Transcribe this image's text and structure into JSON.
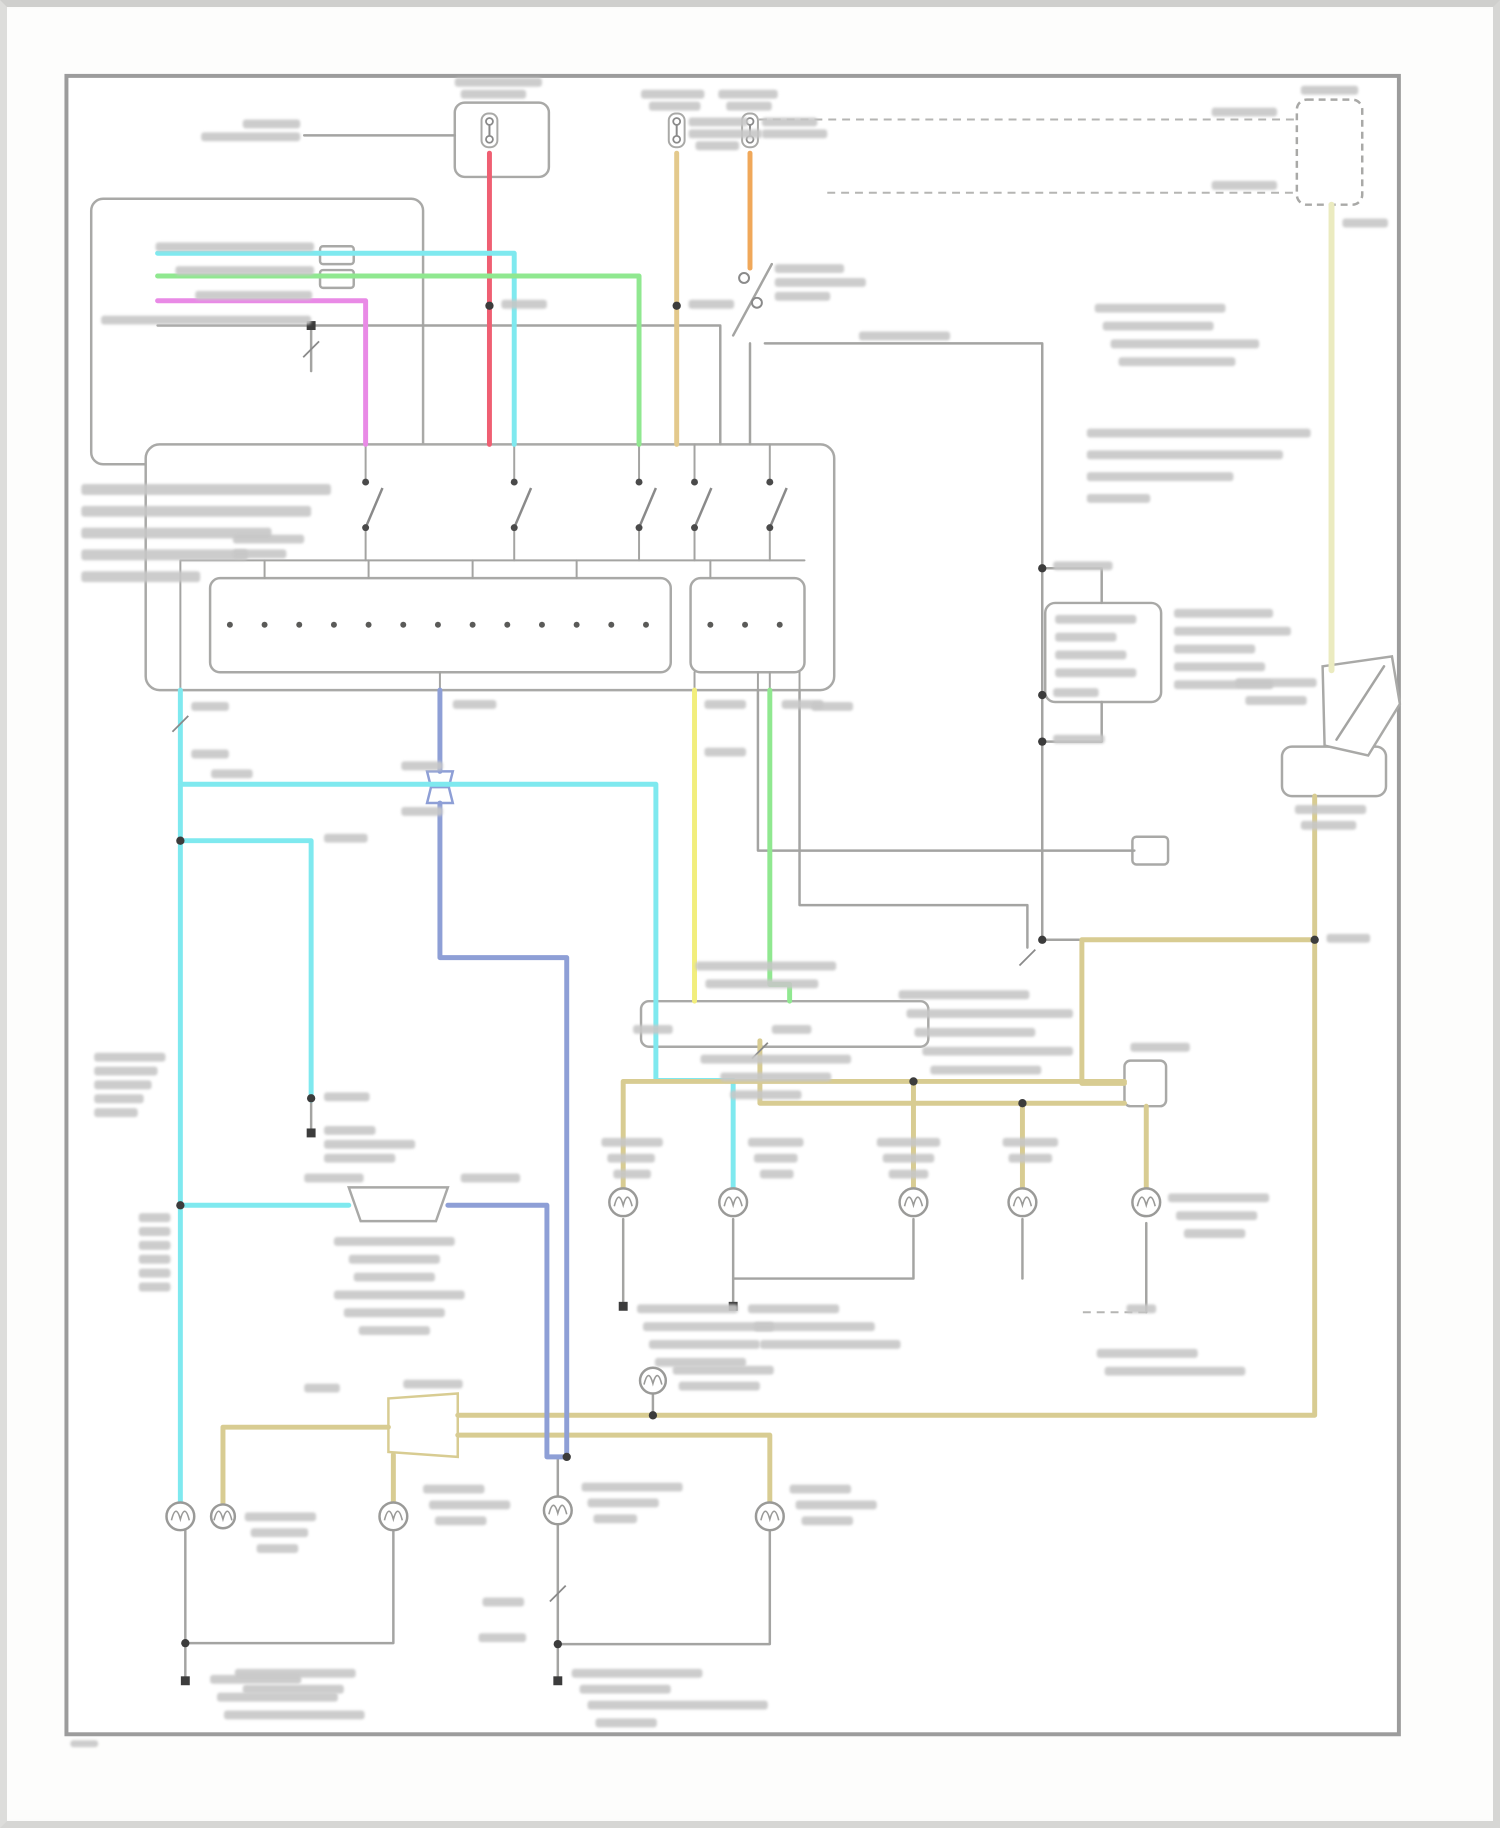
{
  "canvas": {
    "w": 1500,
    "h": 1828,
    "sheet": "#fdfdfc"
  },
  "frame": {
    "x": 60,
    "y": 68,
    "w": 1345,
    "h": 1674,
    "stroke": "#9c9c9c",
    "width": 4
  },
  "palette": {
    "gray": "#a4a4a2",
    "darkgray": "#8a8a8a",
    "boxstroke": "#a9a9a7",
    "cyan": "#7fe9ef",
    "green": "#90e890",
    "magenta": "#e98ae6",
    "red": "#ef5f72",
    "tan": "#e3c98c",
    "orange": "#f0a85a",
    "khaki": "#d8cc92",
    "paleyellow": "#ebebc0",
    "yellow": "#f2ee7c",
    "blue": "#8e9fd6",
    "smudge": "#c7c7c7",
    "dot": "#3c3c3c"
  },
  "diagram": {
    "boxes": [
      [
        452,
        95,
        95,
        75,
        10,
        0
      ],
      [
        85,
        192,
        335,
        268,
        12,
        0
      ],
      [
        140,
        440,
        695,
        248,
        14,
        0
      ],
      [
        205,
        575,
        465,
        95,
        10,
        0
      ],
      [
        690,
        575,
        115,
        95,
        10,
        0
      ],
      [
        1302,
        92,
        66,
        106,
        10,
        1
      ],
      [
        1048,
        600,
        117,
        100,
        10,
        0
      ],
      [
        1287,
        745,
        105,
        50,
        10,
        0
      ],
      [
        640,
        1002,
        290,
        46,
        8,
        0
      ],
      [
        1128,
        1062,
        42,
        46,
        6,
        0
      ],
      [
        1136,
        836,
        36,
        28,
        4,
        0
      ],
      [
        316,
        240,
        34,
        18,
        3,
        0
      ],
      [
        316,
        264,
        34,
        18,
        3,
        0
      ]
    ],
    "polygons": [
      [
        "1328,664 1398,654 1406,702 1374,754 1330,744",
        "boxstroke"
      ],
      [
        "345,1190 445,1190 433,1224 357,1224",
        "boxstroke"
      ],
      [
        "385,1403 455,1398 455,1462 385,1457",
        "khaki"
      ],
      [
        "424,770 450,770 446,786 428,786",
        "blue"
      ],
      [
        "428,786 446,786 450,802 424,802",
        "blue"
      ]
    ],
    "wires": [
      [
        "gray",
        2.5,
        "300,128 452,128"
      ],
      [
        "gray",
        2.5,
        "733,330 772,258"
      ],
      [
        "gray",
        2.5,
        "750,338 750,440"
      ],
      [
        "gray",
        2.5,
        "765,338 1045,338 1045,940"
      ],
      [
        "gray",
        2.5,
        "152,320 720,320 720,440"
      ],
      [
        "gray",
        2.5,
        "307,320 307,366"
      ],
      [
        "gray",
        2.5,
        "758,688 758,850 1138,850"
      ],
      [
        "gray",
        2.5,
        "800,688 800,905 1030,905 1030,948"
      ],
      [
        "gray",
        2.5,
        "1342,738 1390,664"
      ],
      [
        "gray",
        2.5,
        "652,1398 652,1420"
      ],
      [
        "gray",
        2.5,
        "556,1462 556,1502"
      ],
      [
        "gray",
        2.5,
        "180,1536 180,1688"
      ],
      [
        "gray",
        2.5,
        "390,1536 390,1650 180,1650"
      ],
      [
        "gray",
        2.5,
        "556,1530 556,1688"
      ],
      [
        "gray",
        2.5,
        "770,1536 770,1651 556,1651"
      ],
      [
        "gray",
        2.5,
        "733,1222 733,1310"
      ],
      [
        "gray",
        2.5,
        "915,1222 915,1282 733,1282"
      ],
      [
        "gray",
        2.5,
        "622,1222 622,1310"
      ],
      [
        "gray",
        2.5,
        "1025,1222 1025,1282"
      ],
      [
        "gray",
        2.5,
        "1150,1226 1150,1316"
      ],
      [
        "gray",
        2.5,
        "307,1100 307,1135"
      ],
      [
        "gray",
        2.5,
        "1105,600 1105,565 1045,565"
      ],
      [
        "gray",
        2.5,
        "1105,700 1105,740 1045,740"
      ],
      [
        "gray",
        2.5,
        "1085,940 1045,940"
      ],
      [
        "gray",
        2,
        "362,440 362,478"
      ],
      [
        "gray",
        2,
        "512,440 512,478"
      ],
      [
        "gray",
        2,
        "638,440 638,478"
      ],
      [
        "gray",
        2,
        "694,440 694,478"
      ],
      [
        "gray",
        2,
        "770,440 770,478"
      ],
      [
        "gray",
        2,
        "362,524 362,557"
      ],
      [
        "gray",
        2,
        "512,524 512,557"
      ],
      [
        "gray",
        2,
        "638,524 638,557"
      ],
      [
        "gray",
        2,
        "694,524 694,557"
      ],
      [
        "gray",
        2,
        "770,524 770,557"
      ],
      [
        "gray",
        2,
        "175,557 805,557"
      ],
      [
        "gray",
        2,
        "260,557 260,575"
      ],
      [
        "gray",
        2,
        "365,557 365,575"
      ],
      [
        "gray",
        2,
        "470,557 470,575"
      ],
      [
        "gray",
        2,
        "575,557 575,575"
      ],
      [
        "gray",
        2,
        "710,557 710,575"
      ],
      [
        "gray",
        2,
        "175,557 175,688"
      ],
      [
        "gray",
        2,
        "437,670 437,688"
      ],
      [
        "gray",
        2,
        "694,670 694,688"
      ],
      [
        "gray",
        2,
        "770,670 770,688"
      ],
      [
        "gray",
        2,
        "758,670 758,688"
      ],
      [
        "gray",
        2,
        "800,670 800,688"
      ],
      [
        "red",
        5,
        "487,146 487,440"
      ],
      [
        "tan",
        5,
        "676,146 676,440"
      ],
      [
        "orange",
        5,
        "750,146 750,262"
      ],
      [
        "magenta",
        5,
        "152,295 362,295 362,440"
      ],
      [
        "cyan",
        5,
        "152,247 512,247 512,440"
      ],
      [
        "green",
        5,
        "152,270 638,270 638,440"
      ],
      [
        "cyan",
        5,
        "175,688 175,1508"
      ],
      [
        "cyan",
        5,
        "175,783 655,783 655,1082 733,1082 733,1191"
      ],
      [
        "cyan",
        5,
        "175,840 307,840 307,1102"
      ],
      [
        "cyan",
        5,
        "175,1208 345,1208"
      ],
      [
        "khaki",
        5,
        "218,1508 218,1432 385,1432"
      ],
      [
        "khaki",
        5,
        "390,1460 390,1508"
      ],
      [
        "khaki",
        5,
        "455,1420 1320,1420 1320,795"
      ],
      [
        "khaki",
        5,
        "455,1440 770,1440 770,1508"
      ],
      [
        "khaki",
        5,
        "1320,940 1085,940 1085,1085 1128,1085"
      ],
      [
        "khaki",
        5,
        "622,1191 622,1083 1128,1083"
      ],
      [
        "khaki",
        5,
        "915,1083 915,1191"
      ],
      [
        "khaki",
        5,
        "760,1042 760,1105 1128,1105"
      ],
      [
        "khaki",
        5,
        "1025,1105 1025,1191"
      ],
      [
        "khaki",
        5,
        "1150,1108 1150,1191"
      ],
      [
        "paleyellow",
        6,
        "1337,198 1337,668"
      ],
      [
        "yellow",
        5,
        "694,688 694,1002"
      ],
      [
        "green",
        5,
        "770,688 770,985 790,985 790,1002"
      ],
      [
        "blue",
        5,
        "437,688 437,770"
      ],
      [
        "blue",
        5,
        "437,802 437,958 565,958 565,1462"
      ],
      [
        "blue",
        5,
        "445,1208 545,1208 545,1462 565,1462"
      ]
    ],
    "dashed": [
      "745,112 1302,112",
      "828,186 1302,186",
      "1086,1316 1150,1316"
    ],
    "fuses": [
      [
        487,
        123
      ],
      [
        676,
        123
      ],
      [
        750,
        123
      ]
    ],
    "switches": [
      [
        362,
        500
      ],
      [
        512,
        500
      ],
      [
        638,
        500
      ],
      [
        694,
        500
      ],
      [
        770,
        500
      ]
    ],
    "rings": [
      [
        744,
        272
      ],
      [
        757,
        297
      ]
    ],
    "lamps": [
      [
        175,
        1522,
        14
      ],
      [
        218,
        1522,
        12
      ],
      [
        390,
        1522,
        14
      ],
      [
        556,
        1516,
        14
      ],
      [
        770,
        1522,
        14
      ],
      [
        652,
        1385,
        13
      ],
      [
        622,
        1205,
        14
      ],
      [
        733,
        1205,
        14
      ],
      [
        915,
        1205,
        14
      ],
      [
        1025,
        1205,
        14
      ],
      [
        1150,
        1205,
        14
      ]
    ],
    "innerdots": [
      [
        225,
        622
      ],
      [
        260,
        622
      ],
      [
        295,
        622
      ],
      [
        330,
        622
      ],
      [
        365,
        622
      ],
      [
        400,
        622
      ],
      [
        435,
        622
      ],
      [
        470,
        622
      ],
      [
        505,
        622
      ],
      [
        540,
        622
      ],
      [
        575,
        622
      ],
      [
        610,
        622
      ],
      [
        645,
        622
      ],
      [
        710,
        622
      ],
      [
        745,
        622
      ],
      [
        780,
        622
      ]
    ],
    "dots": [
      [
        487,
        300
      ],
      [
        676,
        300
      ],
      [
        175,
        840
      ],
      [
        175,
        1208
      ],
      [
        307,
        1100
      ],
      [
        565,
        1462
      ],
      [
        915,
        1083
      ],
      [
        1025,
        1105
      ],
      [
        1320,
        940
      ],
      [
        1045,
        565
      ],
      [
        1045,
        693
      ],
      [
        1045,
        740
      ],
      [
        1045,
        940
      ],
      [
        180,
        1650
      ],
      [
        556,
        1651
      ],
      [
        652,
        1420
      ]
    ],
    "squares": [
      [
        307,
        320
      ],
      [
        307,
        1135
      ],
      [
        180,
        1688
      ],
      [
        556,
        1688
      ],
      [
        622,
        1310
      ],
      [
        733,
        1310
      ]
    ],
    "slashes": [
      [
        175,
        722
      ],
      [
        307,
        344
      ],
      [
        556,
        1600
      ],
      [
        760,
        1052
      ],
      [
        1030,
        958
      ]
    ],
    "smudges": [
      [
        452,
        70,
        88
      ],
      [
        458,
        82,
        66
      ],
      [
        238,
        112,
        58
      ],
      [
        196,
        125,
        100
      ],
      [
        640,
        82,
        64
      ],
      [
        648,
        94,
        52
      ],
      [
        688,
        110,
        60
      ],
      [
        688,
        122,
        74
      ],
      [
        695,
        134,
        44
      ],
      [
        718,
        82,
        60
      ],
      [
        726,
        94,
        46
      ],
      [
        762,
        110,
        56
      ],
      [
        762,
        122,
        66
      ],
      [
        499,
        294,
        46
      ],
      [
        688,
        294,
        46
      ],
      [
        775,
        258,
        70
      ],
      [
        775,
        272,
        92
      ],
      [
        775,
        286,
        56
      ],
      [
        860,
        326,
        92
      ],
      [
        1216,
        100,
        66
      ],
      [
        1216,
        174,
        66
      ],
      [
        1306,
        78,
        58
      ],
      [
        1348,
        212,
        46
      ],
      [
        1098,
        298,
        132
      ],
      [
        1106,
        316,
        112
      ],
      [
        1114,
        334,
        150
      ],
      [
        1122,
        352,
        118
      ],
      [
        1090,
        424,
        226
      ],
      [
        1090,
        446,
        198
      ],
      [
        1090,
        468,
        148
      ],
      [
        1090,
        490,
        64
      ],
      [
        1056,
        558,
        60
      ],
      [
        1056,
        686,
        46
      ],
      [
        1056,
        733,
        52
      ],
      [
        1058,
        612,
        82
      ],
      [
        1058,
        630,
        62
      ],
      [
        1058,
        648,
        72
      ],
      [
        1058,
        666,
        82
      ],
      [
        1178,
        606,
        100
      ],
      [
        1178,
        624,
        118
      ],
      [
        1178,
        642,
        82
      ],
      [
        1178,
        660,
        92
      ],
      [
        1178,
        678,
        100
      ],
      [
        1240,
        676,
        82
      ],
      [
        1250,
        694,
        62
      ],
      [
        1300,
        804,
        72
      ],
      [
        1306,
        820,
        56
      ],
      [
        1332,
        934,
        44
      ],
      [
        900,
        991,
        132
      ],
      [
        908,
        1010,
        168
      ],
      [
        916,
        1029,
        122
      ],
      [
        924,
        1048,
        152
      ],
      [
        932,
        1067,
        112
      ],
      [
        150,
        236,
        160
      ],
      [
        170,
        260,
        140
      ],
      [
        190,
        285,
        118
      ],
      [
        95,
        310,
        212
      ],
      [
        75,
        480,
        252,
        11
      ],
      [
        75,
        502,
        232,
        11
      ],
      [
        75,
        524,
        192,
        11
      ],
      [
        75,
        546,
        168,
        11
      ],
      [
        75,
        568,
        120,
        11
      ],
      [
        228,
        531,
        72
      ],
      [
        228,
        546,
        54
      ],
      [
        186,
        700,
        38
      ],
      [
        186,
        748,
        38
      ],
      [
        206,
        768,
        42
      ],
      [
        398,
        760,
        42
      ],
      [
        398,
        806,
        42
      ],
      [
        450,
        698,
        44
      ],
      [
        320,
        833,
        44
      ],
      [
        704,
        698,
        42
      ],
      [
        704,
        746,
        42
      ],
      [
        782,
        698,
        42
      ],
      [
        812,
        700,
        42
      ],
      [
        320,
        1094,
        46
      ],
      [
        320,
        1128,
        52
      ],
      [
        320,
        1142,
        92
      ],
      [
        320,
        1156,
        72
      ],
      [
        88,
        1054,
        72
      ],
      [
        88,
        1068,
        64
      ],
      [
        88,
        1082,
        58
      ],
      [
        88,
        1096,
        50
      ],
      [
        88,
        1110,
        44
      ],
      [
        133,
        1216,
        32
      ],
      [
        133,
        1230,
        32
      ],
      [
        133,
        1244,
        32
      ],
      [
        133,
        1258,
        32
      ],
      [
        133,
        1272,
        32
      ],
      [
        133,
        1286,
        32
      ],
      [
        300,
        1176,
        60
      ],
      [
        458,
        1176,
        60
      ],
      [
        330,
        1240,
        122
      ],
      [
        345,
        1258,
        92
      ],
      [
        350,
        1276,
        82
      ],
      [
        330,
        1294,
        132
      ],
      [
        340,
        1312,
        102
      ],
      [
        355,
        1330,
        72
      ],
      [
        695,
        962,
        142
      ],
      [
        705,
        980,
        114
      ],
      [
        700,
        1056,
        152
      ],
      [
        720,
        1074,
        112
      ],
      [
        730,
        1092,
        72
      ],
      [
        632,
        1026,
        40
      ],
      [
        772,
        1026,
        40
      ],
      [
        600,
        1140,
        62
      ],
      [
        606,
        1156,
        48
      ],
      [
        612,
        1172,
        38
      ],
      [
        748,
        1140,
        56
      ],
      [
        754,
        1156,
        44
      ],
      [
        760,
        1172,
        34
      ],
      [
        878,
        1140,
        64
      ],
      [
        884,
        1156,
        52
      ],
      [
        890,
        1172,
        40
      ],
      [
        1005,
        1140,
        56
      ],
      [
        1011,
        1156,
        44
      ],
      [
        1134,
        1044,
        60
      ],
      [
        1172,
        1196,
        102
      ],
      [
        1180,
        1214,
        82
      ],
      [
        1188,
        1232,
        62
      ],
      [
        636,
        1308,
        102
      ],
      [
        642,
        1326,
        132
      ],
      [
        648,
        1344,
        112
      ],
      [
        654,
        1362,
        92
      ],
      [
        748,
        1308,
        92
      ],
      [
        754,
        1326,
        122
      ],
      [
        760,
        1344,
        142
      ],
      [
        1100,
        1353,
        102
      ],
      [
        1108,
        1371,
        142
      ],
      [
        1130,
        1308,
        30
      ],
      [
        240,
        1518,
        72
      ],
      [
        246,
        1534,
        58
      ],
      [
        252,
        1550,
        42
      ],
      [
        420,
        1490,
        62
      ],
      [
        426,
        1506,
        82
      ],
      [
        432,
        1522,
        52
      ],
      [
        580,
        1488,
        102
      ],
      [
        586,
        1504,
        72
      ],
      [
        592,
        1520,
        44
      ],
      [
        790,
        1490,
        62
      ],
      [
        796,
        1506,
        82
      ],
      [
        802,
        1522,
        52
      ],
      [
        672,
        1370,
        102
      ],
      [
        678,
        1386,
        82
      ],
      [
        400,
        1384,
        60
      ],
      [
        300,
        1388,
        36
      ],
      [
        480,
        1604,
        42
      ],
      [
        476,
        1640,
        48
      ],
      [
        205,
        1682,
        92
      ],
      [
        212,
        1700,
        122
      ],
      [
        219,
        1718,
        142
      ],
      [
        230,
        1676,
        122
      ],
      [
        238,
        1692,
        102
      ],
      [
        570,
        1676,
        132
      ],
      [
        578,
        1692,
        92
      ],
      [
        586,
        1708,
        182
      ],
      [
        594,
        1726,
        62
      ],
      [
        64,
        1748,
        28,
        7
      ]
    ]
  }
}
